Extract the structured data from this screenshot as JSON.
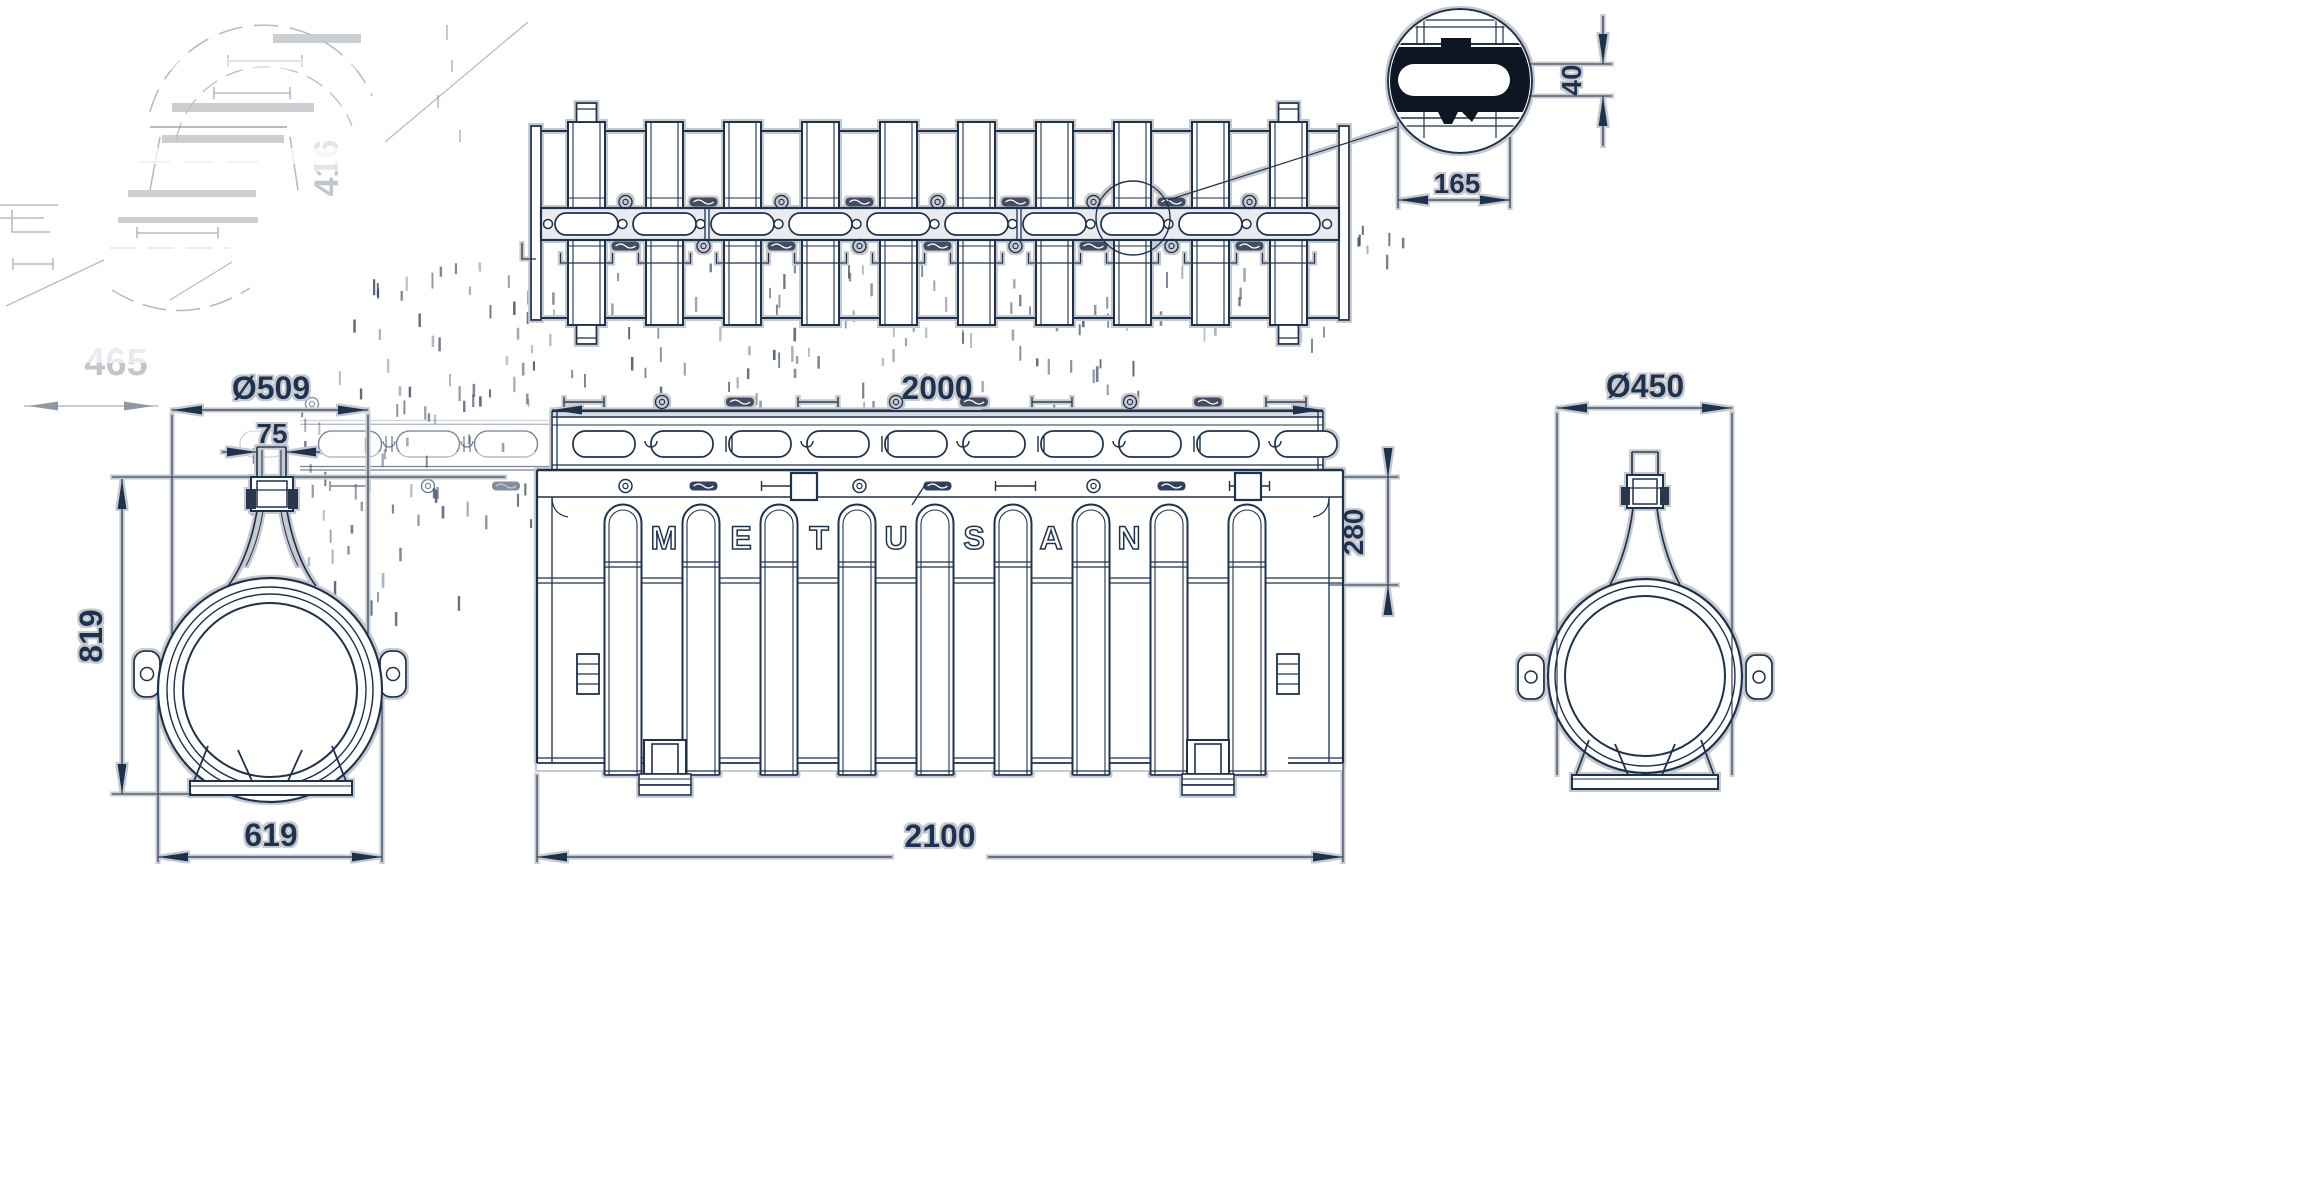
{
  "drawing": {
    "type": "technical-drawing",
    "product_text": "METUSAN",
    "brand_letters": [
      "M",
      "E",
      "T",
      "U",
      "S",
      "A",
      "N"
    ],
    "dimensions": {
      "grate_length": "2000",
      "body_length": "2100",
      "body_height": "280",
      "left_view_diameter": "Ø509",
      "left_view_neck_width": "75",
      "left_view_height": "819",
      "left_view_base_width": "619",
      "right_view_diameter": "Ø450",
      "detail_slot_length": "165",
      "detail_slot_height": "40"
    },
    "ghost_texts": {
      "faded_dim_width": "465",
      "faded_dim_side": "416"
    },
    "colors": {
      "ink": "#1e3050",
      "halo": "#c6c9cd",
      "ghost": "#7d8796",
      "paper": "#ffffff",
      "slot_fill": "#0b1220",
      "band_fill": "#e9ebee"
    }
  }
}
